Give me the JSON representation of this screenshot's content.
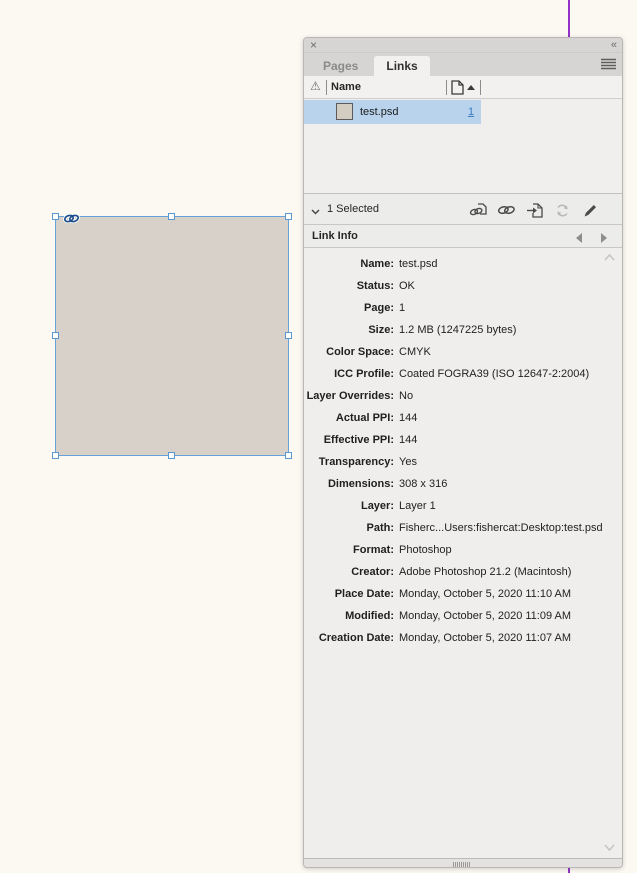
{
  "canvas": {
    "placed_frame": {
      "fill": "#d7d1ca",
      "selection_color": "#66a1d9",
      "link_badge_icon": "chain-link"
    },
    "margin_guide_color": "#9431c8",
    "background": "#fbf9f1"
  },
  "panel": {
    "titlebar": {
      "close_icon": "x",
      "collapse_icon": "«"
    },
    "tabs": [
      {
        "label": "Pages",
        "active": false
      },
      {
        "label": "Links",
        "active": true
      }
    ],
    "menu_icon": "hamburger",
    "columns": {
      "status_icon": "⚠",
      "name_header": "Name",
      "page_icon": "page",
      "sort_icon": "sort-ascending"
    },
    "rows": [
      {
        "name": "test.psd",
        "page": "1",
        "thumb_color": "#d3ccc1",
        "selected": true
      }
    ],
    "toolbar": {
      "selected_label": "1 Selected",
      "buttons": [
        {
          "name": "relink-from-cc-libraries",
          "enabled": true
        },
        {
          "name": "relink",
          "enabled": true
        },
        {
          "name": "go-to-link",
          "enabled": true
        },
        {
          "name": "update-link",
          "enabled": false
        },
        {
          "name": "edit-original",
          "enabled": true
        }
      ]
    },
    "link_info": {
      "title": "Link Info",
      "fields": [
        {
          "label": "Name:",
          "value": "test.psd"
        },
        {
          "label": "Status:",
          "value": "OK"
        },
        {
          "label": "Page:",
          "value": "1"
        },
        {
          "label": "Size:",
          "value": "1.2 MB (1247225 bytes)"
        },
        {
          "label": "Color Space:",
          "value": "CMYK"
        },
        {
          "label": "ICC Profile:",
          "value": "Coated FOGRA39 (ISO 12647-2:2004)"
        },
        {
          "label": "Layer Overrides:",
          "value": "No"
        },
        {
          "label": "Actual PPI:",
          "value": "144"
        },
        {
          "label": "Effective PPI:",
          "value": "144"
        },
        {
          "label": "Transparency:",
          "value": "Yes"
        },
        {
          "label": "Dimensions:",
          "value": "308 x 316"
        },
        {
          "label": "Layer:",
          "value": "Layer 1"
        },
        {
          "label": "Path:",
          "value": "Fisherc...Users:fishercat:Desktop:test.psd"
        },
        {
          "label": "Format:",
          "value": "Photoshop"
        },
        {
          "label": "Creator:",
          "value": "Adobe Photoshop 21.2 (Macintosh)"
        },
        {
          "label": "Place Date:",
          "value": "Monday, October 5, 2020 11:10 AM"
        },
        {
          "label": "Modified:",
          "value": "Monday, October 5, 2020 11:09 AM"
        },
        {
          "label": "Creation Date:",
          "value": "Monday, October 5, 2020 11:07 AM"
        }
      ]
    }
  }
}
